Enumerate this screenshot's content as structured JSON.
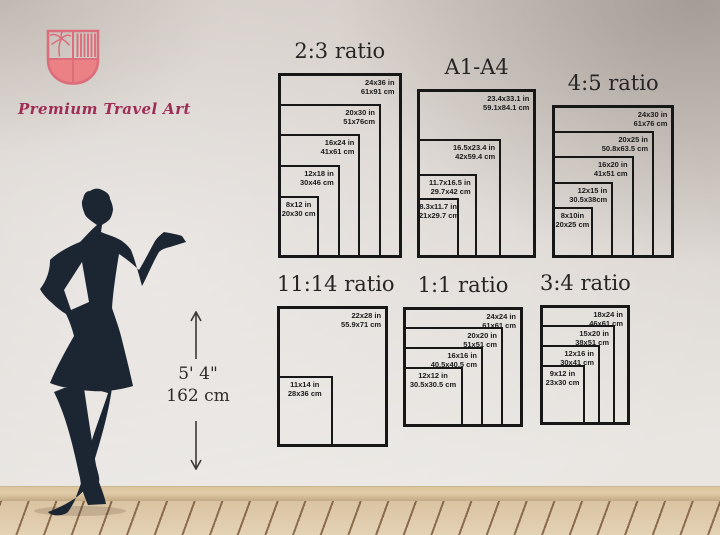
{
  "logo": {
    "brand": "Premium Travel Art"
  },
  "height_reference": {
    "imperial": "5' 4\"",
    "metric": "162 cm"
  },
  "charts": [
    {
      "title": "2:3 ratio",
      "sizes": [
        {
          "inches": "24x36 in",
          "cm": "61x91 cm"
        },
        {
          "inches": "20x30 in",
          "cm": "51x76cm"
        },
        {
          "inches": "16x24 in",
          "cm": "41x61 cm"
        },
        {
          "inches": "12x18 in",
          "cm": "30x46 cm"
        },
        {
          "inches": "8x12 in",
          "cm": "20x30 cm"
        }
      ]
    },
    {
      "title": "A1-A4",
      "sizes": [
        {
          "inches": "23.4x33.1 in",
          "cm": "59.1x84.1 cm"
        },
        {
          "inches": "16.5x23.4 in",
          "cm": "42x59.4 cm"
        },
        {
          "inches": "11.7x16.5 in",
          "cm": "29.7x42 cm"
        },
        {
          "inches": "8.3x11.7 in",
          "cm": "21x29.7 cm"
        }
      ]
    },
    {
      "title": "4:5 ratio",
      "sizes": [
        {
          "inches": "24x30 in",
          "cm": "61x76 cm"
        },
        {
          "inches": "20x25 in",
          "cm": "50.8x63.5 cm"
        },
        {
          "inches": "16x20 in",
          "cm": "41x51 cm"
        },
        {
          "inches": "12x15 in",
          "cm": "30.5x38cm"
        },
        {
          "inches": "8x10in",
          "cm": "20x25 cm"
        }
      ]
    },
    {
      "title": "11:14 ratio",
      "sizes": [
        {
          "inches": "22x28 in",
          "cm": "55.9x71 cm"
        },
        {
          "inches": "11x14 in",
          "cm": "28x36 cm"
        }
      ]
    },
    {
      "title": "1:1 ratio",
      "sizes": [
        {
          "inches": "24x24 in",
          "cm": "61x61 cm"
        },
        {
          "inches": "20x20 in",
          "cm": "51x51 cm"
        },
        {
          "inches": "16x16 in",
          "cm": "40.5x40.5 cm"
        },
        {
          "inches": "12x12 in",
          "cm": "30.5x30.5 cm"
        }
      ]
    },
    {
      "title": "3:4 ratio",
      "sizes": [
        {
          "inches": "18x24 in",
          "cm": "46x61 cm"
        },
        {
          "inches": "15x20 in",
          "cm": "38x51 cm"
        },
        {
          "inches": "12x16 in",
          "cm": "30x41 cm"
        },
        {
          "inches": "9x12 in",
          "cm": "23x30 cm"
        }
      ]
    }
  ]
}
